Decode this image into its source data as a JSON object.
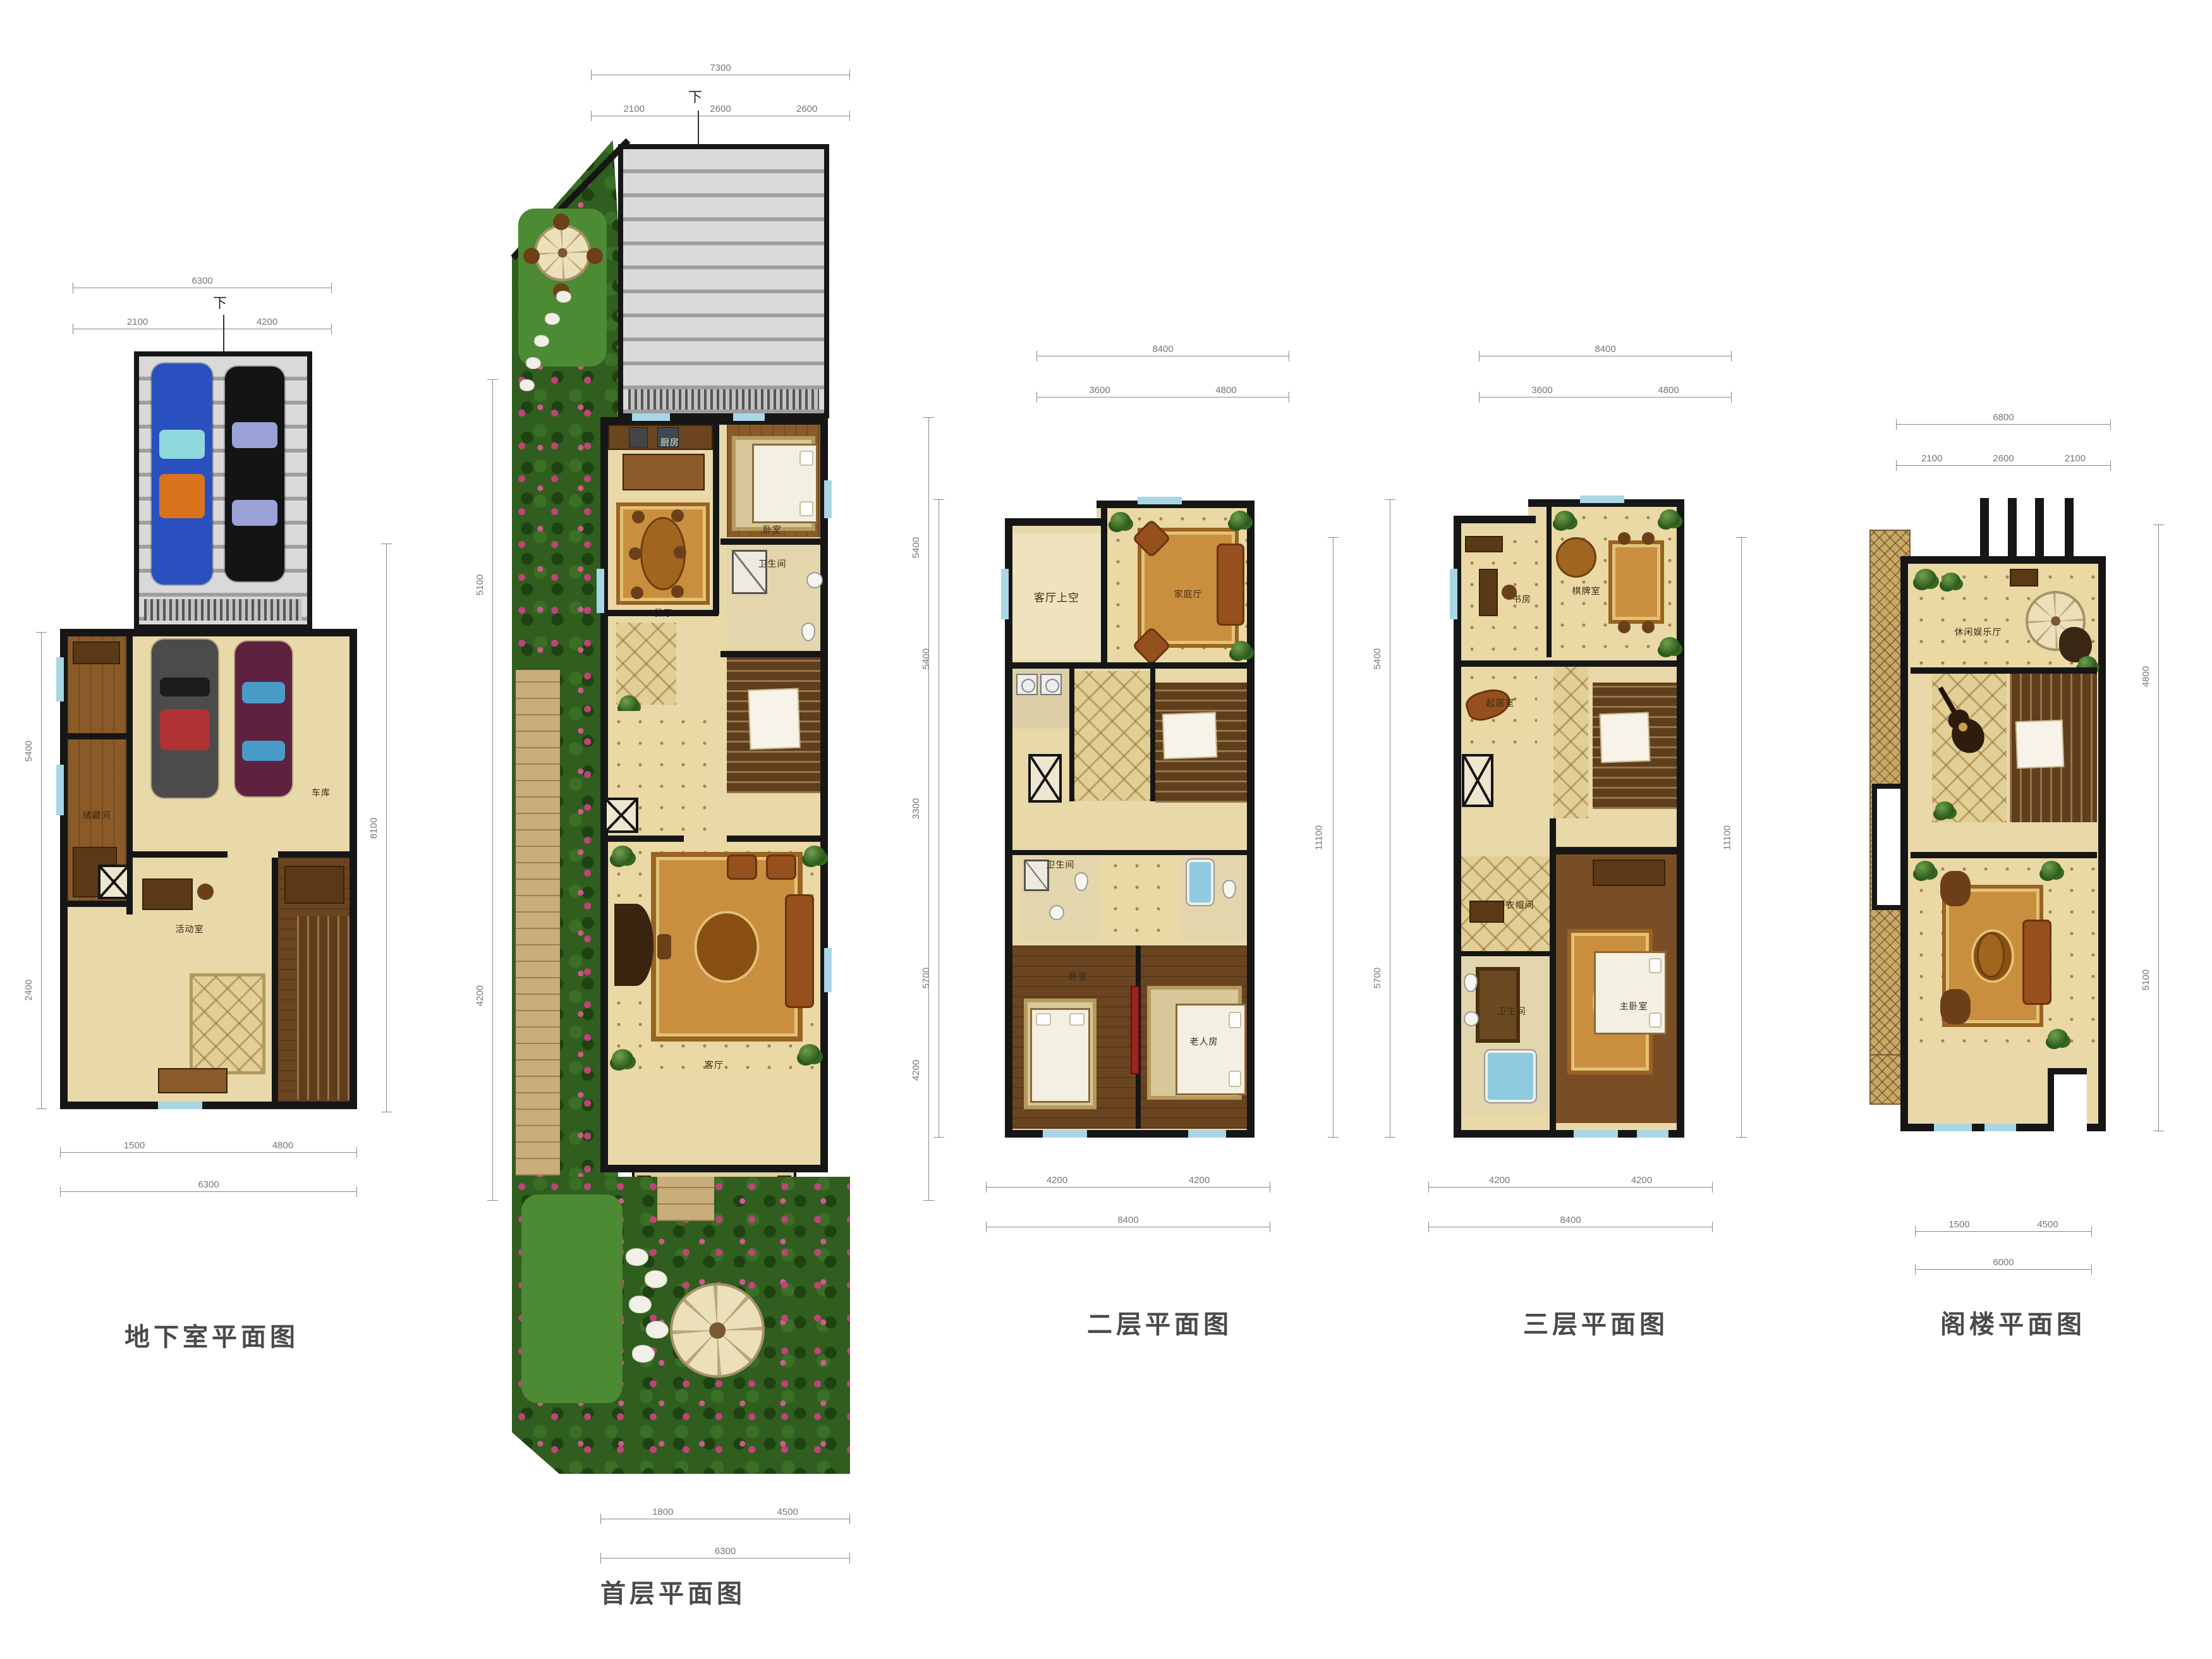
{
  "titles": {
    "basement": "地下室平面图",
    "first": "首层平面图",
    "second": "二层平面图",
    "third": "三层平面图",
    "attic": "阁楼平面图"
  },
  "labels": {
    "down": "下",
    "basement": {
      "garage": "车库",
      "storage": "储藏间",
      "family": "活动室"
    },
    "first": {
      "kitchen": "厨房",
      "dining": "餐厅",
      "bedroom": "卧室",
      "bath": "卫生间",
      "living": "客厅"
    },
    "second": {
      "void": "客厅上空",
      "family": "家庭厅",
      "bed_left": "卧室",
      "bed_right": "老人房",
      "bath": "卫生间"
    },
    "third": {
      "study": "书房",
      "game": "棋牌室",
      "sitting": "起居室",
      "cloak": "衣帽间",
      "bath": "卫生间",
      "master": "主卧室"
    },
    "attic": {
      "leisure": "休闲娱乐厅"
    }
  },
  "dims": {
    "basement_top_total": [
      "6300"
    ],
    "basement_top": [
      "2100",
      "4200"
    ],
    "basement_bottom": [
      "1500",
      "4800"
    ],
    "basement_bottom_total": [
      "6300"
    ],
    "basement_left": [
      "5400",
      "2400"
    ],
    "basement_right": [
      "8100"
    ],
    "first_top_total": [
      "7300"
    ],
    "first_top": [
      "2100",
      "2600",
      "2600"
    ],
    "first_bottom": [
      "1800",
      "4500"
    ],
    "first_bottom_total": [
      "6300"
    ],
    "first_left": [
      "5100",
      "4200"
    ],
    "first_right": [
      "5400",
      "3300",
      "4200"
    ],
    "second_top_total": [
      "8400"
    ],
    "second_top": [
      "3600",
      "4800"
    ],
    "second_bottom": [
      "4200",
      "4200"
    ],
    "second_bottom_total": [
      "8400"
    ],
    "second_left": [
      "5400",
      "5700"
    ],
    "second_right": [
      "11100"
    ],
    "third_top_total": [
      "8400"
    ],
    "third_top": [
      "3600",
      "4800"
    ],
    "third_bottom": [
      "4200",
      "4200"
    ],
    "third_bottom_total": [
      "8400"
    ],
    "third_left": [
      "5400",
      "5700"
    ],
    "third_right": [
      "11100"
    ],
    "attic_top_total": [
      "6800"
    ],
    "attic_top": [
      "2100",
      "2600",
      "2100"
    ],
    "attic_bottom": [
      "1500",
      "4500"
    ],
    "attic_bottom_total": [
      "6000"
    ],
    "attic_right": [
      "4800",
      "5100"
    ]
  }
}
